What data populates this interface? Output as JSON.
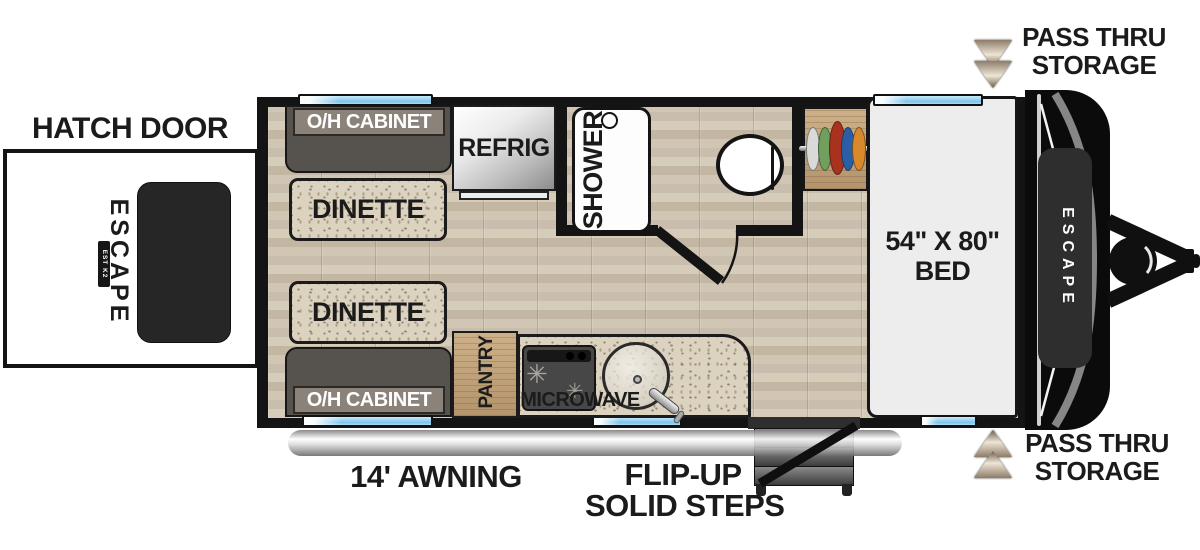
{
  "title": "Escape travel trailer floor plan",
  "exterior": {
    "hatch_door_label": "HATCH DOOR",
    "pass_thru_top": {
      "line1": "PASS THRU",
      "line2": "STORAGE"
    },
    "pass_thru_bottom": {
      "line1": "PASS THRU",
      "line2": "STORAGE"
    },
    "awning_label": "14' AWNING",
    "steps": {
      "line1": "FLIP-UP",
      "line2": "SOLID STEPS"
    },
    "brand_rear": "ESCAPE",
    "brand_rear_badge": "EST K2 1972",
    "brand_front": "ESCAPE"
  },
  "interior": {
    "oh_cabinet_top": "O/H CABINET",
    "oh_cabinet_bottom": "O/H CABINET",
    "dinette_top": "DINETTE",
    "dinette_bottom": "DINETTE",
    "refrig": "REFRIG",
    "shower": "SHOWER",
    "pantry": "PANTRY",
    "microwave": "MICROWAVE",
    "bed": {
      "line1": "54\" X 80\"",
      "line2": "BED"
    }
  },
  "icons": {
    "burner_glyph": "✳"
  },
  "wardrobe": {
    "hanger_colors": [
      "#d9d9d9",
      "#71a05e",
      "#a8321e",
      "#2a5fa8",
      "#d8892c"
    ]
  },
  "colors": {
    "wall": "#141414",
    "window_blue": "#8ecdf0",
    "floor_wood": "#cfc5b2",
    "bench_gray": "#56524d",
    "cabinet_bar": "#8b837a",
    "table_speckle": "#dbd2bf",
    "pantry_wood": "#c2a37c",
    "bed_gray": "#ededed",
    "arrow_tan": "#efe5d4",
    "arrow_dark": "#6b5b49"
  }
}
